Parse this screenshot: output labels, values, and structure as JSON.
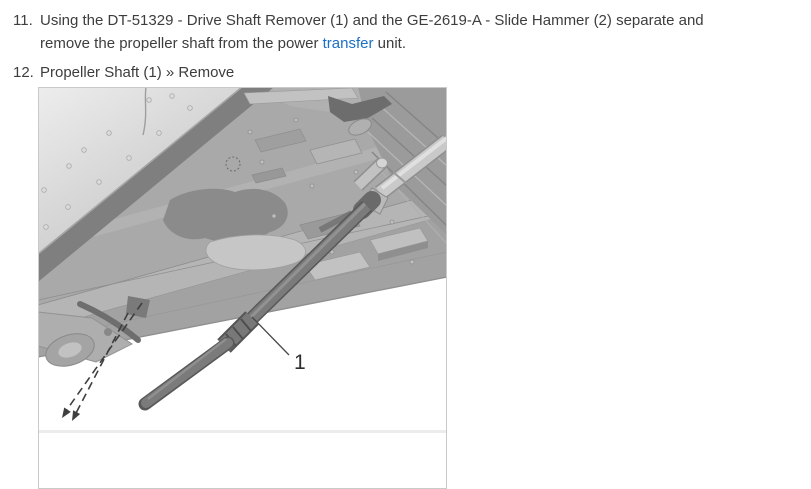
{
  "list": {
    "items": [
      {
        "number": "11.",
        "line1": "Using the DT-51329 - Drive Shaft Remover (1) and the GE-2619-A - Slide Hammer (2) separate and",
        "line2_pre": "remove the propeller shaft from the power ",
        "line2_link": "transfer",
        "line2_post": " unit."
      },
      {
        "number": "12.",
        "text": "Propeller Shaft (1) » Remove"
      }
    ]
  },
  "figure": {
    "callout_label": "1"
  },
  "colors": {
    "text": "#3d3d3d",
    "link": "#1b6fc4",
    "figure_border": "#c9c9c9",
    "shaft_dark": "#6f6f6f",
    "panel_gray": "#a9a9a9"
  }
}
